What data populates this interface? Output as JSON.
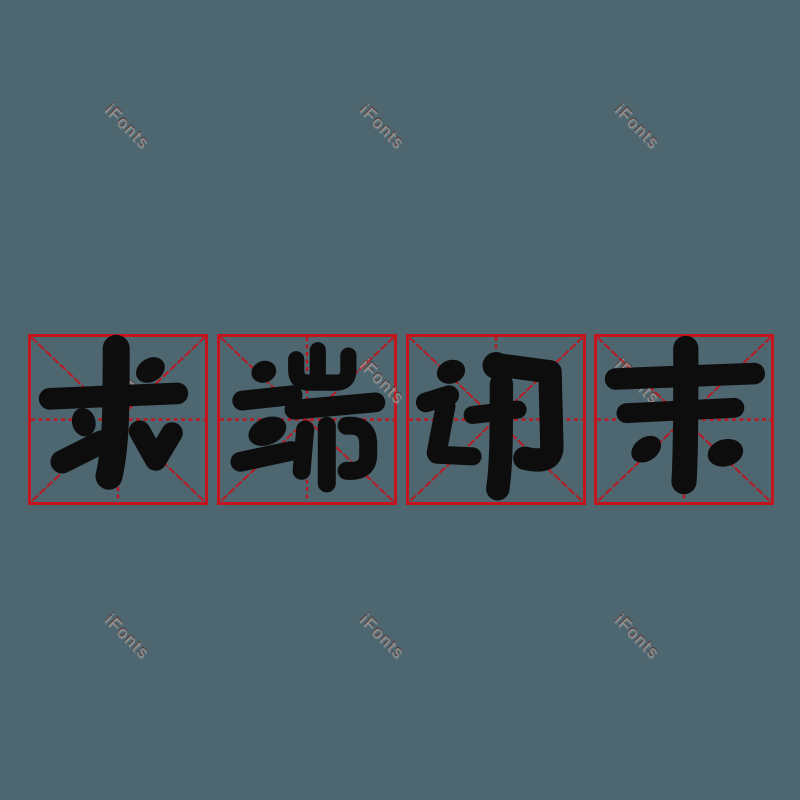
{
  "artboard": {
    "background_color": "#4d6670",
    "width": 800,
    "height": 800
  },
  "phrase": {
    "text": "求端讯末",
    "characters": [
      {
        "char": "求"
      },
      {
        "char": "端"
      },
      {
        "char": "讯"
      },
      {
        "char": "末"
      }
    ],
    "ink_color": "#0d0d0d"
  },
  "practice_grid": {
    "style": "mi-zi-ge",
    "square_count": 4,
    "line_color": "#c3151d"
  },
  "watermark": {
    "text": "iFonts",
    "rotation_deg": 45,
    "color": "#9b9795"
  }
}
